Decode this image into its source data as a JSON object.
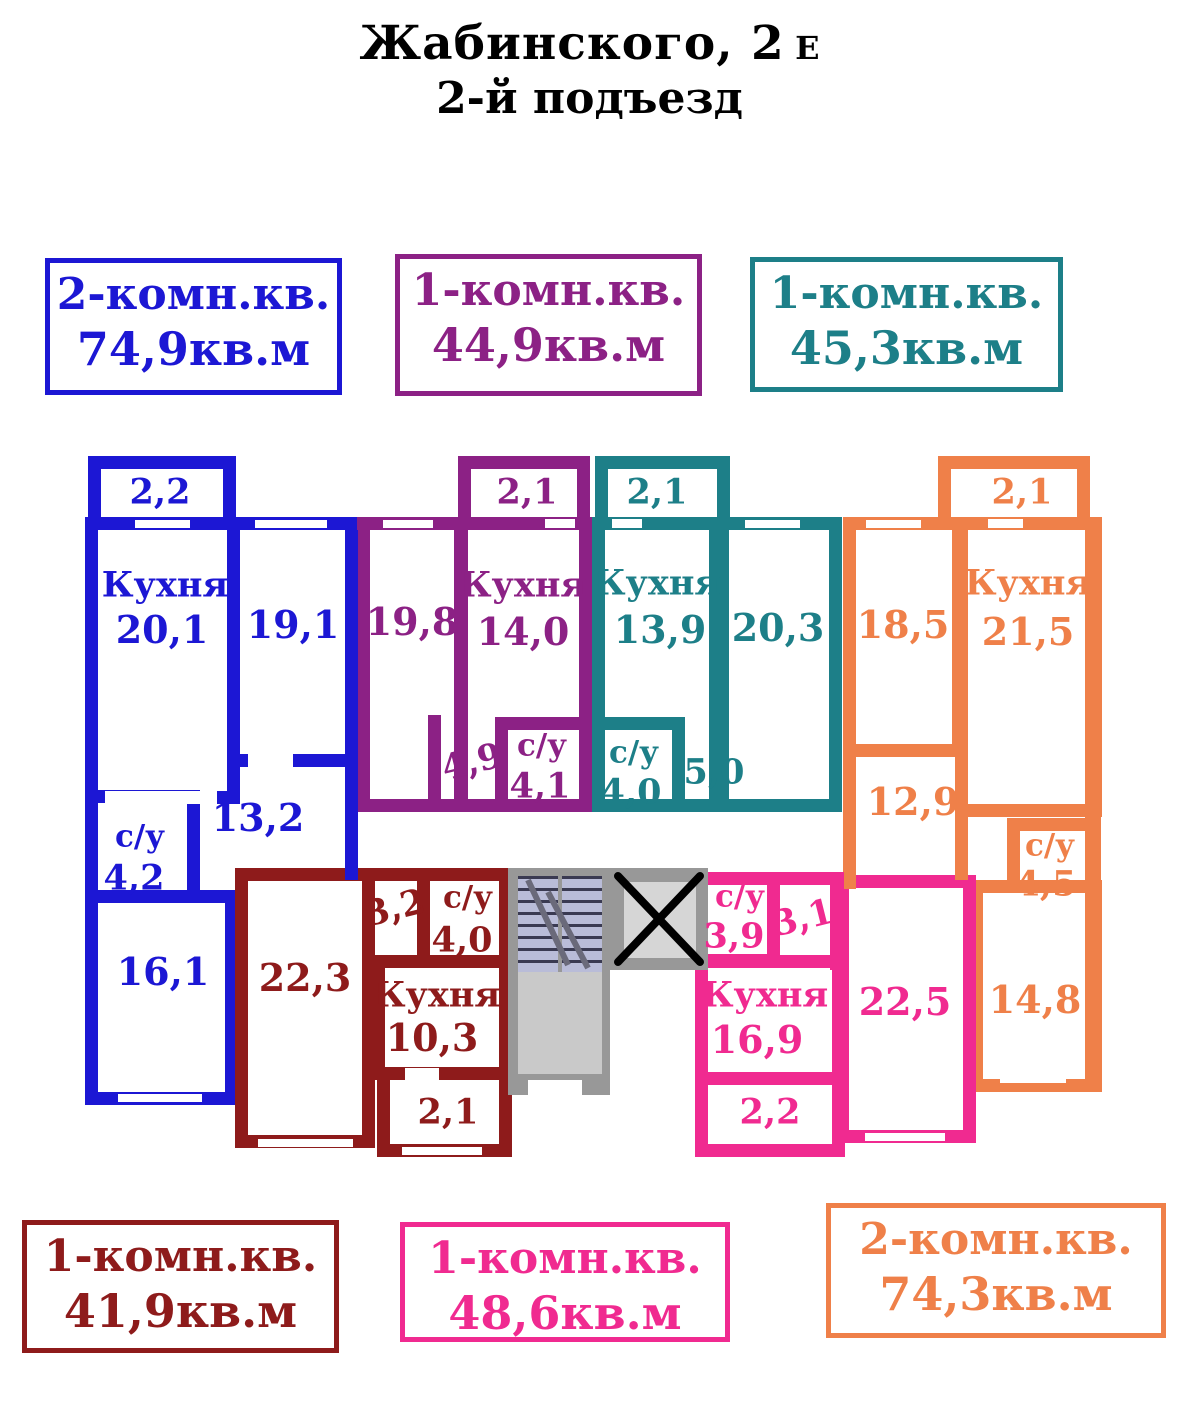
{
  "title": {
    "main": "Жабинского, 2",
    "suffix": "Е",
    "line2": "2-й подъезд"
  },
  "legend": {
    "top": [
      {
        "type": "2-комн.кв.",
        "area": "74,9кв.м",
        "color": "#1c17d4"
      },
      {
        "type": "1-комн.кв.",
        "area": "44,9кв.м",
        "color": "#8c2185"
      },
      {
        "type": "1-комн.кв.",
        "area": "45,3кв.м",
        "color": "#1d7f88"
      }
    ],
    "bottom": [
      {
        "type": "1-комн.кв.",
        "area": "41,9кв.м",
        "color": "#8e1b1b"
      },
      {
        "type": "1-комн.кв.",
        "area": "48,6кв.м",
        "color": "#f02a90"
      },
      {
        "type": "2-комн.кв.",
        "area": "74,3кв.м",
        "color": "#ef8049"
      }
    ]
  },
  "plan": {
    "blue": {
      "balcony": "2,2",
      "kitchen_name": "Кухня",
      "kitchen": "20,1",
      "room1": "19,1",
      "hall": "13,2",
      "wc_name": "с/у",
      "wc": "4,2",
      "room2": "16,1"
    },
    "purple": {
      "balcony": "2,1",
      "room": "19,8",
      "kitchen_name": "Кухня",
      "kitchen": "14,0",
      "hall": "4,9",
      "wc_name": "с/у",
      "wc": "4,1"
    },
    "teal": {
      "balcony": "2,1",
      "kitchen_name": "Кухня",
      "kitchen": "13,9",
      "room": "20,3",
      "wc_name": "с/у",
      "wc": "4,0",
      "hall": "5,0"
    },
    "orange": {
      "balcony": "2,1",
      "room1": "18,5",
      "kitchen_name": "Кухня",
      "kitchen": "21,5",
      "hall": "12,9",
      "wc_name": "с/у",
      "wc": "4,5",
      "room2": "14,8"
    },
    "darkred": {
      "room": "22,3",
      "hall": "3,2",
      "wc_name": "с/у",
      "wc": "4,0",
      "kitchen_name": "Кухня",
      "kitchen": "10,3",
      "balcony": "2,1"
    },
    "pink": {
      "wc_name": "с/у",
      "wc": "3,9",
      "hall": "3,1",
      "kitchen_name": "Кухня",
      "kitchen": "16,9",
      "room": "22,5",
      "balcony": "2,2"
    }
  },
  "colors": {
    "blue": "#1c17d4",
    "purple": "#8c2185",
    "teal": "#1d7f88",
    "darkred": "#8e1b1b",
    "pink": "#f02a90",
    "orange": "#ef8049",
    "stairs": "#989898",
    "landing": "#c9c9c9",
    "elevator": "#d6d6d6"
  }
}
